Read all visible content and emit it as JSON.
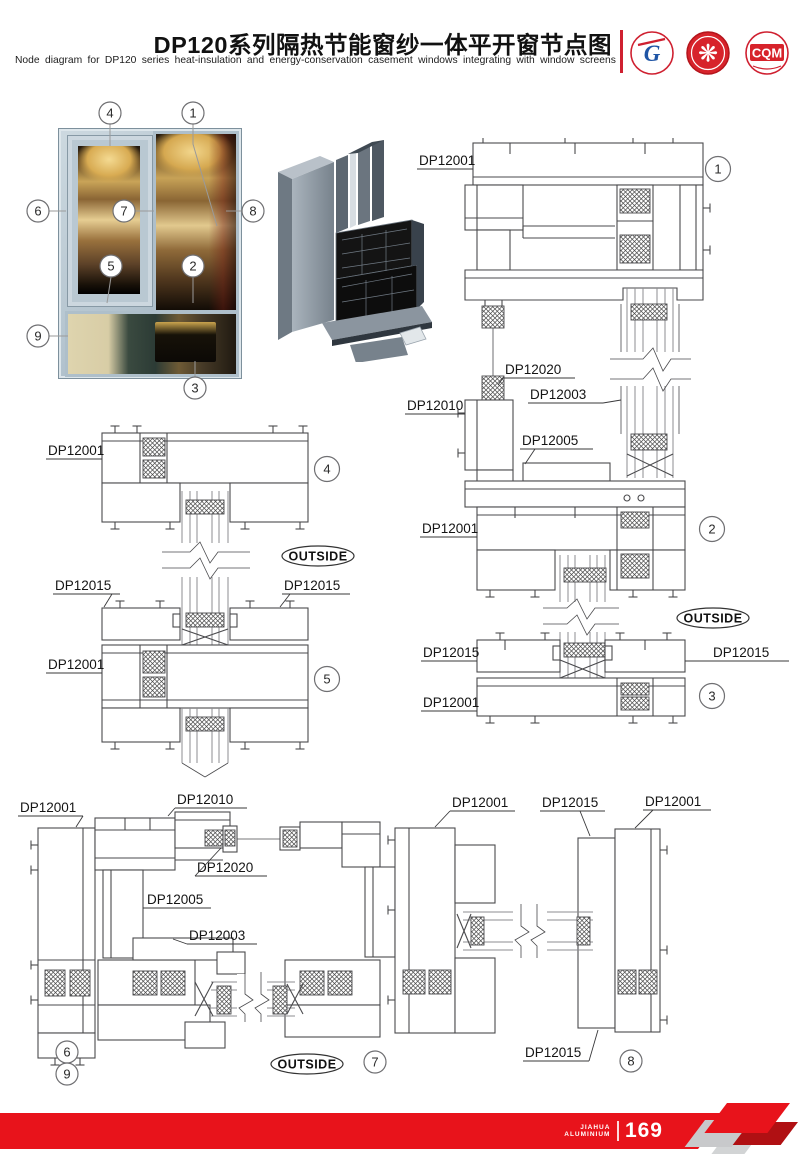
{
  "header": {
    "title": "DP120系列隔热节能窗纱一体平开窗节点图",
    "subtitle": "Node diagram for DP120 series heat-insulation and energy-conservation casement windows integrating with window screens",
    "logo1_text": "G",
    "logo3_text": "CQM"
  },
  "labels": {
    "dp12001": "DP12001",
    "dp12003": "DP12003",
    "dp12005": "DP12005",
    "dp12010": "DP12010",
    "dp12015": "DP12015",
    "dp12020": "DP12020",
    "outside": "OUTSIDE"
  },
  "callouts": {
    "c1": "1",
    "c2": "2",
    "c3": "3",
    "c4": "4",
    "c5": "5",
    "c6": "6",
    "c7": "7",
    "c8": "8",
    "c9": "9"
  },
  "footer": {
    "brand_line1": "JIAHUA",
    "brand_line2": "ALUMINIUM",
    "page_number": "169"
  }
}
